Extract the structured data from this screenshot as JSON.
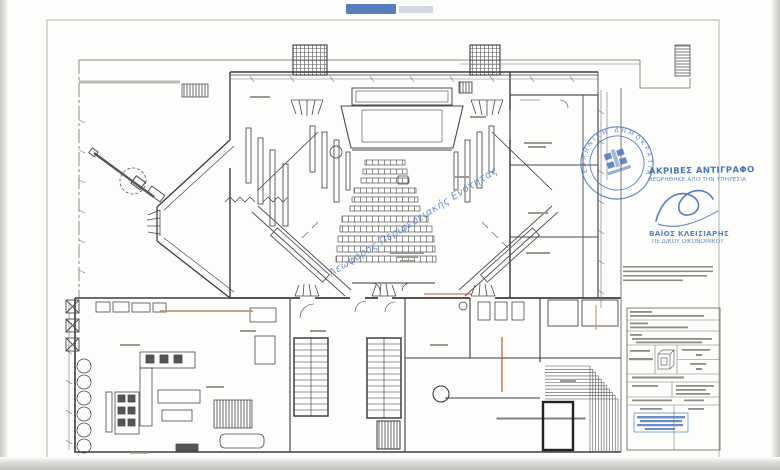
{
  "document": {
    "kind": "scanned architectural floor plan (ground floor, hall with auditorium seating, stage, kitchen wing and stairs)",
    "sheet_border_color": "#b5b5b0",
    "line_color": "#555555",
    "accent_red": "#b5552f"
  },
  "certification": {
    "line1": "ΑΚΡΙΒΕΣ ΑΝΤΙΓΡΑΦΟ",
    "line2": "ΘΕΩΡΗΘΗΚΕ ΑΠΟ ΤΗΝ ΥΠΗΡΕΣΙΑ",
    "color": "#3f6cb4"
  },
  "signer": {
    "name": "ΒΑΪΟΣ ΚΛΕΙΣΙΑΡΗΣ",
    "title": "ΠΕ Δ/ΚΟΥ ΟΙΚΟΝΟΜΙΚΟΥ"
  },
  "seal": {
    "ring_text": "ΕΛΛΗΝΙΚΗ ΔΗΜΟΚΡΑΤΙΑ",
    "color": "#4470b8"
  },
  "watermark": {
    "text": "Λεωφόρος Περιφερειακής Ενότητας",
    "color": "#4a7bc8",
    "angle_deg": -32
  },
  "title_block": {
    "stamp_color": "#3b69b5",
    "note": "title block text illegible in scan"
  }
}
